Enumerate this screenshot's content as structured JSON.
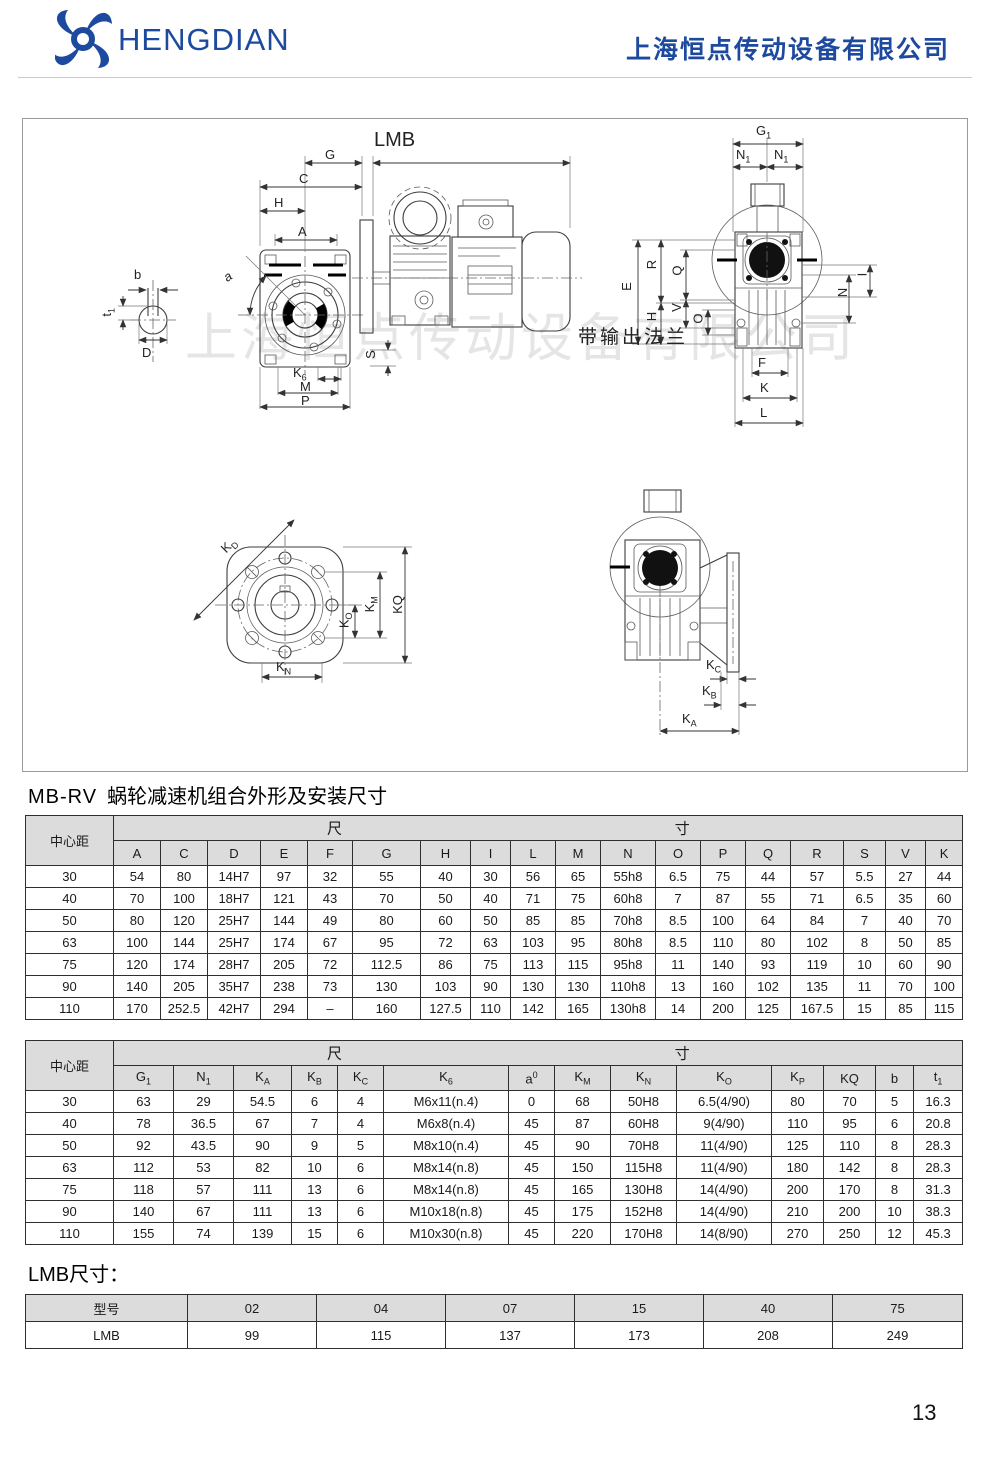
{
  "header": {
    "brand": "HENGDIAN",
    "company": "上海恒点传动设备有限公司"
  },
  "colors": {
    "brand_blue": "#1d4a9e",
    "table_header_bg": "#dcdcdc"
  },
  "section": {
    "title_model": "MB-RV",
    "title_text": "蜗轮减速机组合外形及安装尺寸",
    "lmb_title": "LMB尺寸："
  },
  "page": {
    "number": "13"
  },
  "drawings": {
    "watermark": "上海恒点传动设备有限公司",
    "flange_note": "带输出法兰",
    "assembly": {
      "lmb": "LMB",
      "g": "G",
      "c": "C",
      "h": "H",
      "a": "A",
      "angle": "a",
      "b": "b",
      "t1": {
        "t": "t",
        "s": "1"
      },
      "d": "D",
      "s": "S",
      "k6": {
        "t": "K",
        "s": "6"
      },
      "m": "M",
      "p": "P"
    },
    "end_view": {
      "g1": {
        "t": "G",
        "s": "1"
      },
      "n1": {
        "t": "N",
        "s": "1"
      },
      "e": "E",
      "r": "R",
      "q": "Q",
      "h": "H",
      "v": "V",
      "o": "O",
      "n": "N",
      "i": "I",
      "f": "F",
      "k": "K",
      "l": "L"
    },
    "flange_face": {
      "kd": {
        "t": "K",
        "s": "D"
      },
      "ko": {
        "t": "K",
        "s": "O"
      },
      "km": {
        "t": "K",
        "s": "M"
      },
      "kq": "KQ",
      "kn": {
        "t": "K",
        "s": "N"
      }
    },
    "flange_side": {
      "kc": {
        "t": "K",
        "s": "C"
      },
      "kb": {
        "t": "K",
        "s": "B"
      },
      "ka": {
        "t": "K",
        "s": "A"
      }
    }
  },
  "table1": {
    "corner": "中心距",
    "group_left": "尺",
    "group_right": "寸",
    "headers": [
      "A",
      "C",
      "D",
      "E",
      "F",
      "G",
      "H",
      "I",
      "L",
      "M",
      "N",
      "O",
      "P",
      "Q",
      "R",
      "S",
      "V",
      "K"
    ],
    "rows": [
      [
        "30",
        "54",
        "80",
        "14H7",
        "97",
        "32",
        "55",
        "40",
        "30",
        "56",
        "65",
        "55h8",
        "6.5",
        "75",
        "44",
        "57",
        "5.5",
        "27",
        "44"
      ],
      [
        "40",
        "70",
        "100",
        "18H7",
        "121",
        "43",
        "70",
        "50",
        "40",
        "71",
        "75",
        "60h8",
        "7",
        "87",
        "55",
        "71",
        "6.5",
        "35",
        "60"
      ],
      [
        "50",
        "80",
        "120",
        "25H7",
        "144",
        "49",
        "80",
        "60",
        "50",
        "85",
        "85",
        "70h8",
        "8.5",
        "100",
        "64",
        "84",
        "7",
        "40",
        "70"
      ],
      [
        "63",
        "100",
        "144",
        "25H7",
        "174",
        "67",
        "95",
        "72",
        "63",
        "103",
        "95",
        "80h8",
        "8.5",
        "110",
        "80",
        "102",
        "8",
        "50",
        "85"
      ],
      [
        "75",
        "120",
        "174",
        "28H7",
        "205",
        "72",
        "112.5",
        "86",
        "75",
        "113",
        "115",
        "95h8",
        "11",
        "140",
        "93",
        "119",
        "10",
        "60",
        "90"
      ],
      [
        "90",
        "140",
        "205",
        "35H7",
        "238",
        "73",
        "130",
        "103",
        "90",
        "130",
        "130",
        "110h8",
        "13",
        "160",
        "102",
        "135",
        "11",
        "70",
        "100"
      ],
      [
        "110",
        "170",
        "252.5",
        "42H7",
        "294",
        "–",
        "160",
        "127.5",
        "110",
        "142",
        "165",
        "130h8",
        "14",
        "200",
        "125",
        "167.5",
        "15",
        "85",
        "115"
      ]
    ]
  },
  "table2": {
    "corner": "中心距",
    "group_left": "尺",
    "group_right": "寸",
    "headers": [
      {
        "t": "G",
        "s": "1"
      },
      {
        "t": "N",
        "s": "1"
      },
      {
        "t": "K",
        "s": "A"
      },
      {
        "t": "K",
        "s": "B"
      },
      {
        "t": "K",
        "s": "C"
      },
      {
        "t": "K",
        "s": "6"
      },
      {
        "t": "a",
        "sup": "0"
      },
      {
        "t": "K",
        "s": "M"
      },
      {
        "t": "K",
        "s": "N"
      },
      {
        "t": "K",
        "s": "O"
      },
      {
        "t": "K",
        "s": "P"
      },
      {
        "t": "KQ"
      },
      {
        "t": "b"
      },
      {
        "t": "t",
        "s": "1"
      }
    ],
    "rows": [
      [
        "30",
        "63",
        "29",
        "54.5",
        "6",
        "4",
        "M6x11(n.4)",
        "0",
        "68",
        "50H8",
        "6.5(4/90)",
        "80",
        "70",
        "5",
        "16.3"
      ],
      [
        "40",
        "78",
        "36.5",
        "67",
        "7",
        "4",
        "M6x8(n.4)",
        "45",
        "87",
        "60H8",
        "9(4/90)",
        "110",
        "95",
        "6",
        "20.8"
      ],
      [
        "50",
        "92",
        "43.5",
        "90",
        "9",
        "5",
        "M8x10(n.4)",
        "45",
        "90",
        "70H8",
        "11(4/90)",
        "125",
        "110",
        "8",
        "28.3"
      ],
      [
        "63",
        "112",
        "53",
        "82",
        "10",
        "6",
        "M8x14(n.8)",
        "45",
        "150",
        "115H8",
        "11(4/90)",
        "180",
        "142",
        "8",
        "28.3"
      ],
      [
        "75",
        "118",
        "57",
        "111",
        "13",
        "6",
        "M8x14(n.8)",
        "45",
        "165",
        "130H8",
        "14(4/90)",
        "200",
        "170",
        "8",
        "31.3"
      ],
      [
        "90",
        "140",
        "67",
        "111",
        "13",
        "6",
        "M10x18(n.8)",
        "45",
        "175",
        "152H8",
        "14(4/90)",
        "210",
        "200",
        "10",
        "38.3"
      ],
      [
        "110",
        "155",
        "74",
        "139",
        "15",
        "6",
        "M10x30(n.8)",
        "45",
        "220",
        "170H8",
        "14(8/90)",
        "270",
        "250",
        "12",
        "45.3"
      ]
    ]
  },
  "table3": {
    "headers": [
      "型号",
      "02",
      "04",
      "07",
      "15",
      "40",
      "75"
    ],
    "rows": [
      [
        "LMB",
        "99",
        "115",
        "137",
        "173",
        "208",
        "249"
      ]
    ]
  }
}
